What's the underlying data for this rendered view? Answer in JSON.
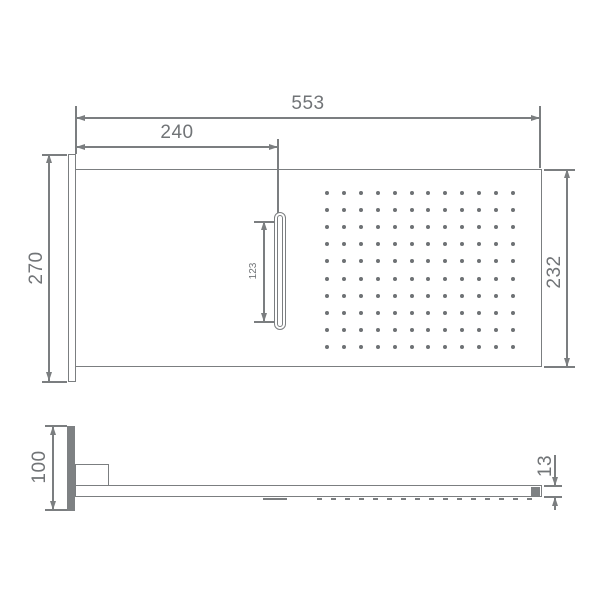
{
  "title": "shower-panel-technical-drawing",
  "units": "mm",
  "colors": {
    "line": "#7b7e80",
    "text": "#717477",
    "dot": "#6e7174",
    "fill": "#7e8183",
    "background": "#ffffff"
  },
  "top_view": {
    "name": "front-view",
    "dimensions": {
      "overall_width": "553",
      "slot_offset": "240",
      "flange_height": "270",
      "face_height": "232",
      "slot_length": "123"
    },
    "nozzle_grid": {
      "cols": 12,
      "rows": 10,
      "x0": 327,
      "y0": 193,
      "dx": 16.9,
      "dy": 17.1,
      "r": 2
    }
  },
  "side_view": {
    "name": "side-view",
    "dimensions": {
      "wall_plate_height": "100",
      "arm_thickness": "13"
    }
  }
}
